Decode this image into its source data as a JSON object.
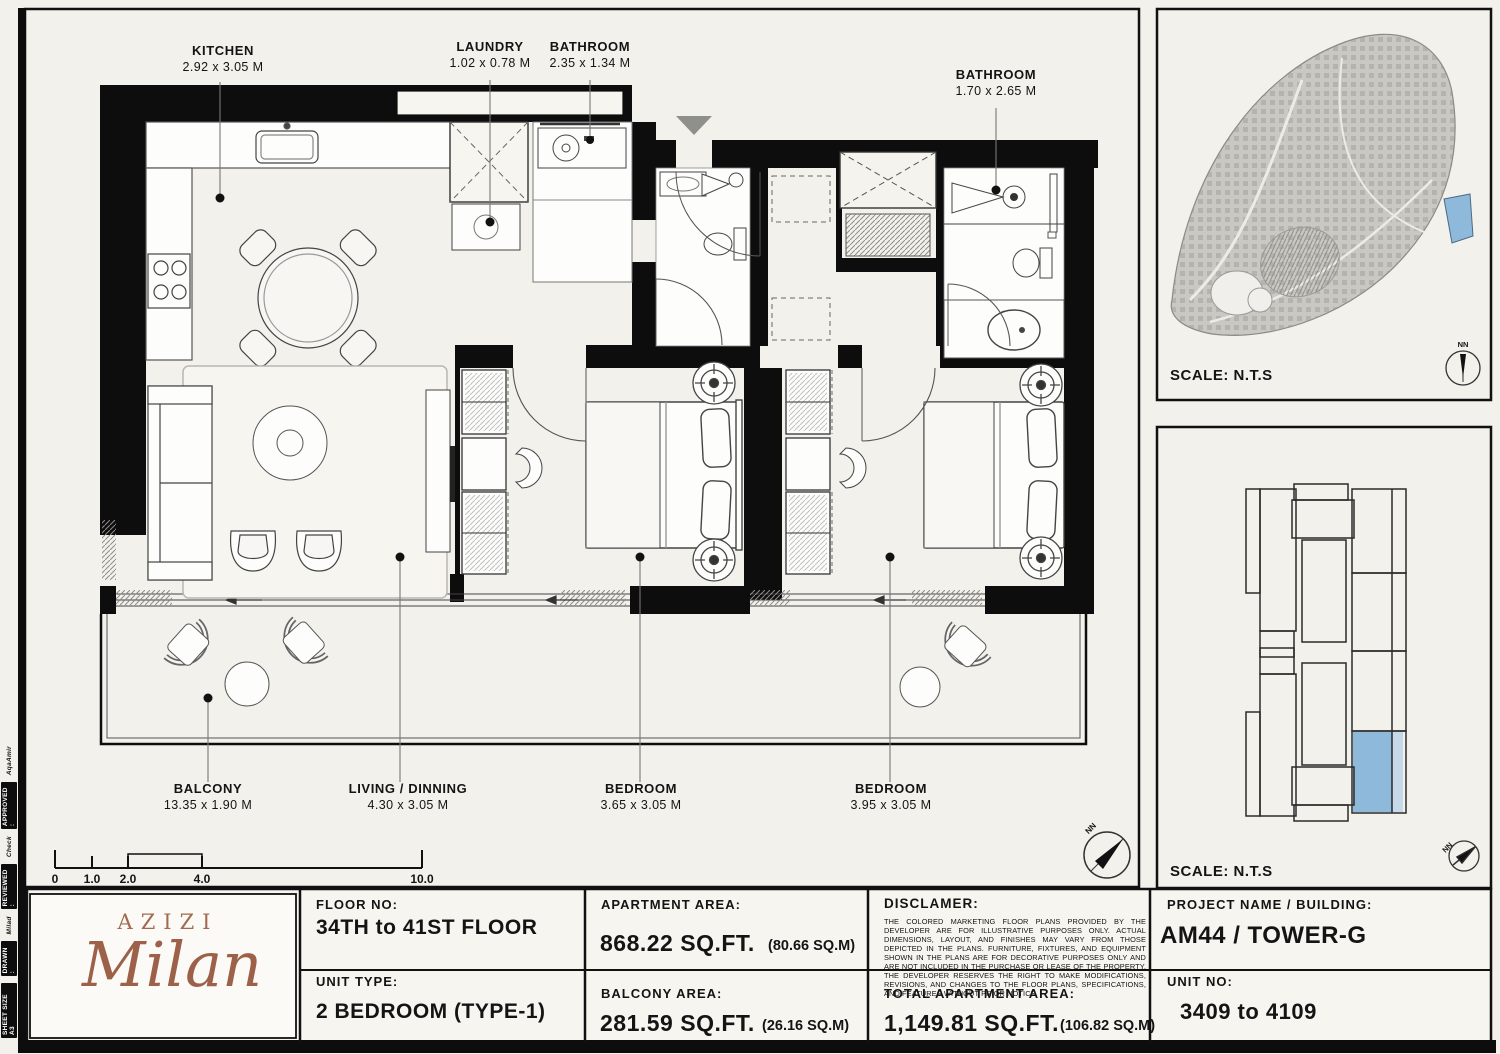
{
  "colors": {
    "paper": "#f3f1ec",
    "wall": "#0d0d0d",
    "highlight_blue": "#8fb9da",
    "logo_bronze": "#a26a4f"
  },
  "margin_strip": {
    "entries": [
      "SHEET SIZE A3",
      "DRAWN :",
      "Milad",
      "REVIEWED :",
      "Check",
      "APPROVED :",
      "AqaAmir"
    ]
  },
  "plan": {
    "rooms": [
      {
        "name": "KITCHEN",
        "dims": "2.92 x 3.05 M"
      },
      {
        "name": "LAUNDRY",
        "dims": "1.02 x 0.78 M"
      },
      {
        "name": "BATHROOM",
        "dims": "2.35 x 1.34 M"
      },
      {
        "name": "BATHROOM",
        "dims": "1.70 x 2.65 M"
      },
      {
        "name": "BALCONY",
        "dims": "13.35 x 1.90 M"
      },
      {
        "name": "LIVING / DINNING",
        "dims": "4.30 x 3.05 M"
      },
      {
        "name": "BEDROOM",
        "dims": "3.65 x 3.05 M"
      },
      {
        "name": "BEDROOM",
        "dims": "3.95 x 3.05 M"
      }
    ],
    "scale_bar": {
      "ticks": [
        "0",
        "1.0",
        "2.0",
        "4.0",
        "10.0"
      ]
    },
    "compass_label": "NN"
  },
  "panels": {
    "site_map": {
      "scale_label": "SCALE: N.T.S",
      "compass_label": "NN"
    },
    "key_plan": {
      "scale_label": "SCALE: N.T.S",
      "compass_label": "NN"
    }
  },
  "title_block": {
    "logo": {
      "brand": "AZIZI",
      "name": "Milan"
    },
    "floor_no": {
      "label": "FLOOR NO:",
      "value": "34TH to 41ST FLOOR"
    },
    "unit_type": {
      "label": "UNIT TYPE:",
      "value": "2 BEDROOM (TYPE-1)"
    },
    "apartment_area": {
      "label": "APARTMENT AREA:",
      "value": "868.22 SQ.FT.",
      "metric": "(80.66 SQ.M)"
    },
    "balcony_area": {
      "label": "BALCONY AREA:",
      "value": "281.59 SQ.FT.",
      "metric": "(26.16 SQ.M)"
    },
    "total_area": {
      "label": "TOTAL APARTMENT AREA:",
      "value": "1,149.81 SQ.FT.",
      "metric": "(106.82 SQ.M)"
    },
    "disclaimer": {
      "label": "DISCLAMER:",
      "text": "THE COLORED MARKETING FLOOR PLANS PROVIDED BY THE DEVELOPER ARE FOR ILLUSTRATIVE PURPOSES ONLY. ACTUAL DIMENSIONS, LAYOUT, AND FINISHES MAY VARY FROM THOSE DEPICTED IN THE PLANS. FURNITURE, FIXTURES, AND EQUIPMENT SHOWN IN THE PLANS ARE FOR DECORATIVE PURPOSES ONLY AND ARE NOT INCLUDED IN THE PURCHASE OR LEASE OF THE PROPERTY. THE DEVELOPER RESERVES THE RIGHT TO MAKE MODIFICATIONS, REVISIONS, AND CHANGES TO THE FLOOR PLANS, SPECIFICATIONS, AND FEATURES WITHOUT PRIOR NOTICE."
    },
    "project": {
      "label": "PROJECT NAME / BUILDING:",
      "value": "AM44 / TOWER-G"
    },
    "unit_no": {
      "label": "UNIT NO:",
      "value": "3409 to 4109"
    }
  }
}
